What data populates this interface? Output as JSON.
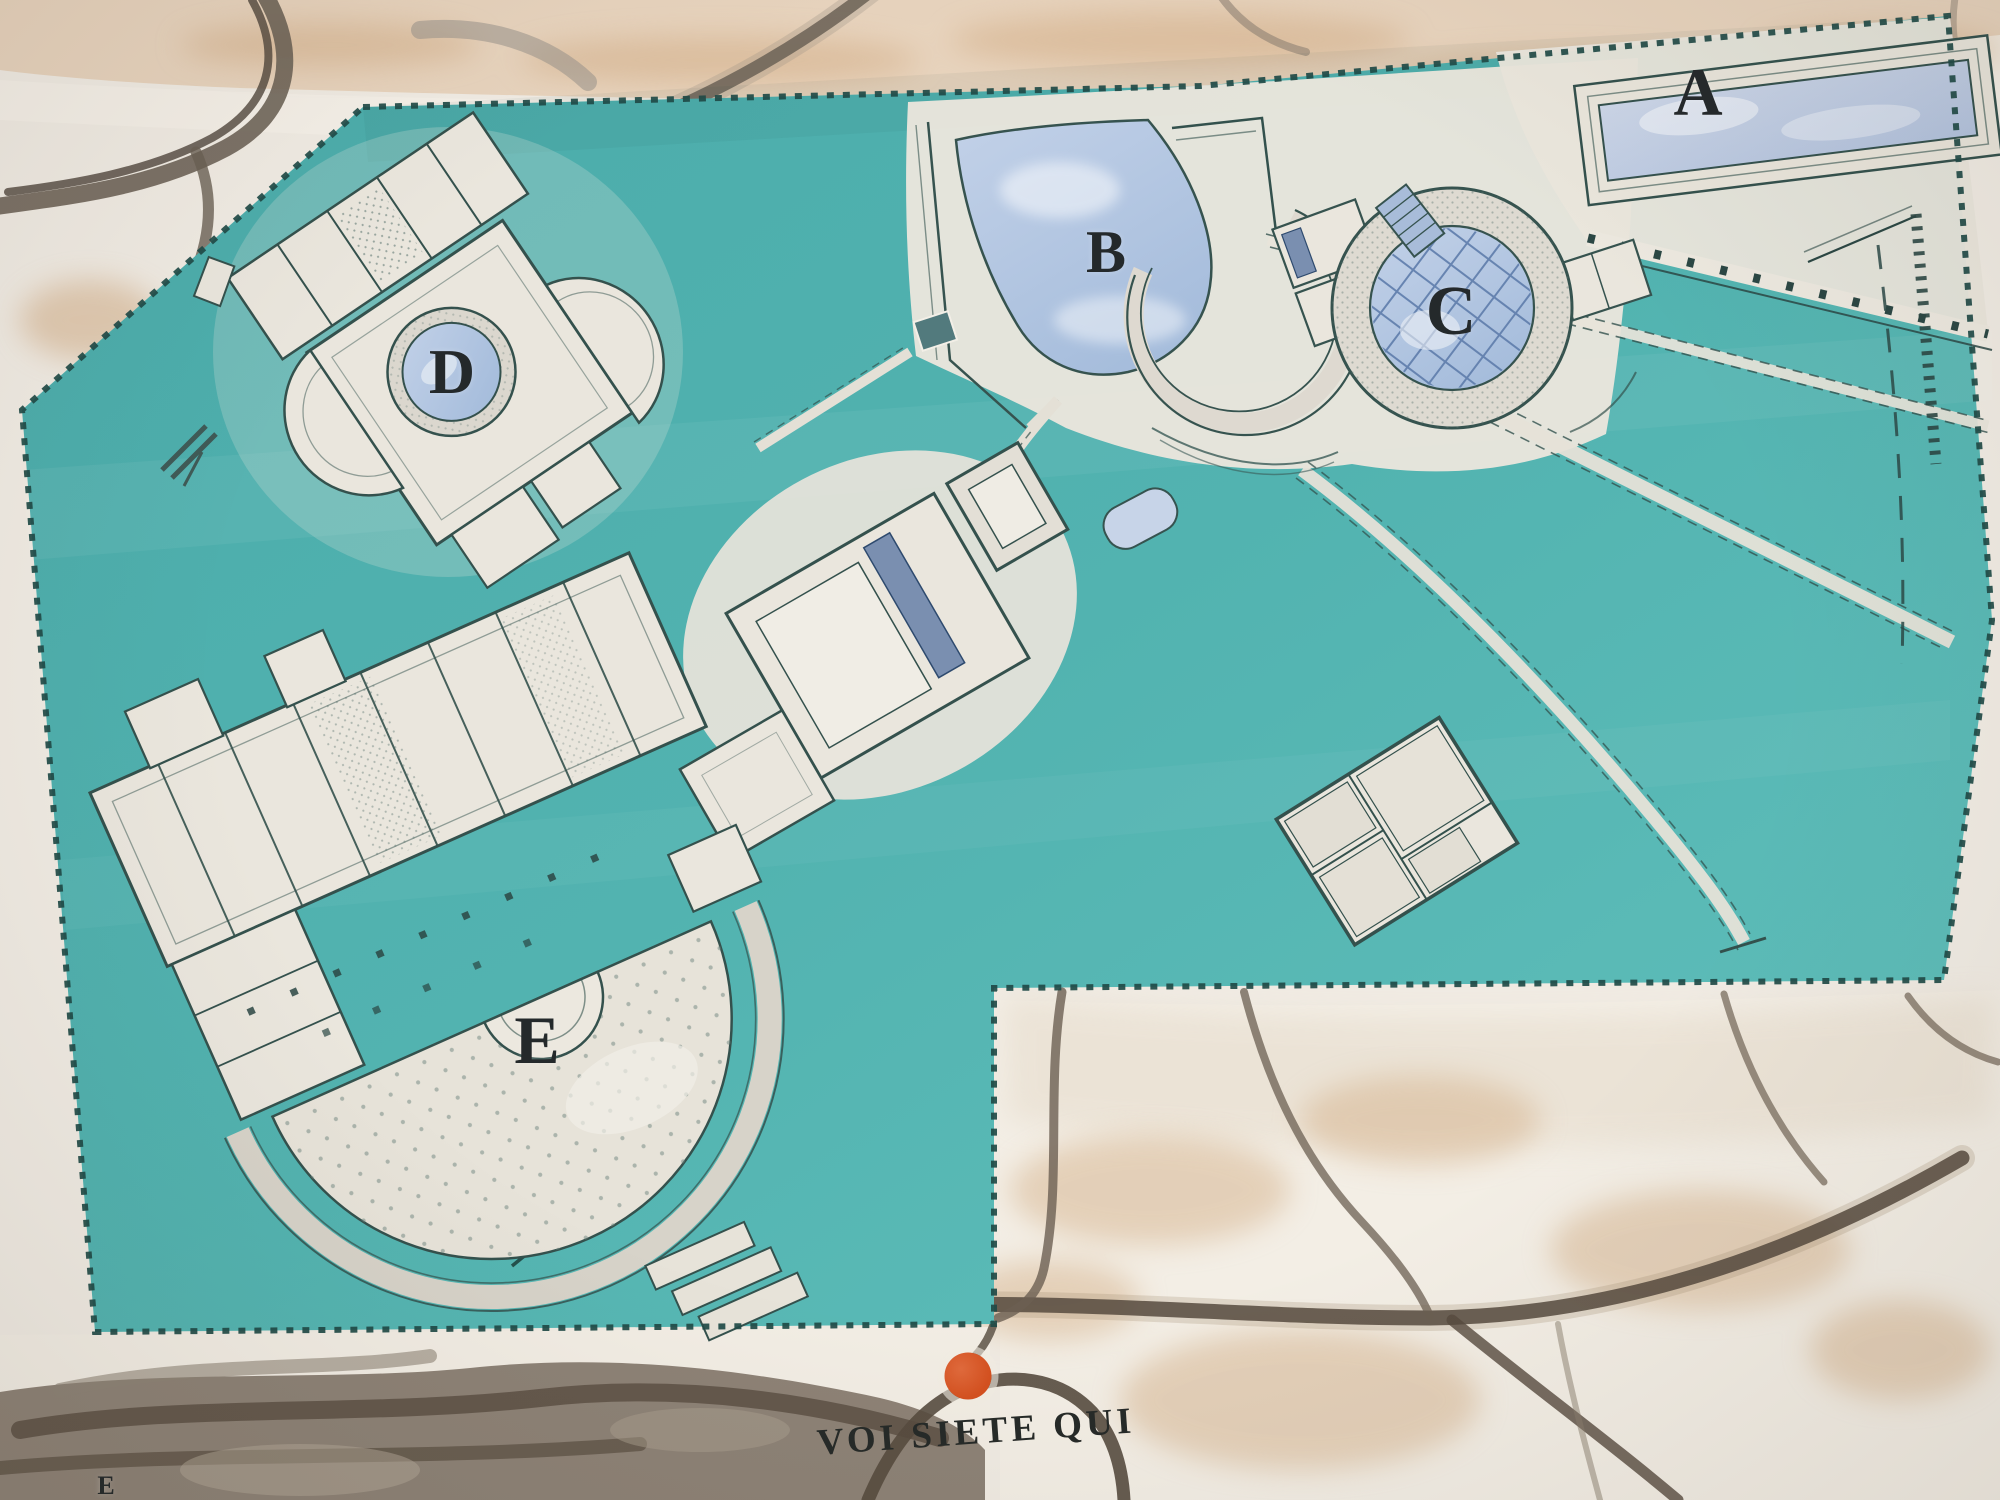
{
  "panel": {
    "type": "archaeological-site-orientation-map",
    "area_labels": [
      {
        "id": "a",
        "text": "A"
      },
      {
        "id": "b",
        "text": "B"
      },
      {
        "id": "c",
        "text": "C"
      },
      {
        "id": "d",
        "text": "D"
      },
      {
        "id": "e",
        "text": "E"
      }
    ],
    "corner_label": "E",
    "you_are_here_label": "VOI SIETE QUI"
  },
  "theme": {
    "teal": "#4caeac",
    "teal_light": "#5fbfbc",
    "ground": "#e9e5dc",
    "bldg": "#eae6dd",
    "pool_blue": "#b7c9e3",
    "wall_ink": "#34514d",
    "marble": "#f0ebe3",
    "marble_stain": "#d3ae87",
    "crack_dark": "#574b3f",
    "marker_red": "#d4501f",
    "label_ink": "#24292b"
  }
}
